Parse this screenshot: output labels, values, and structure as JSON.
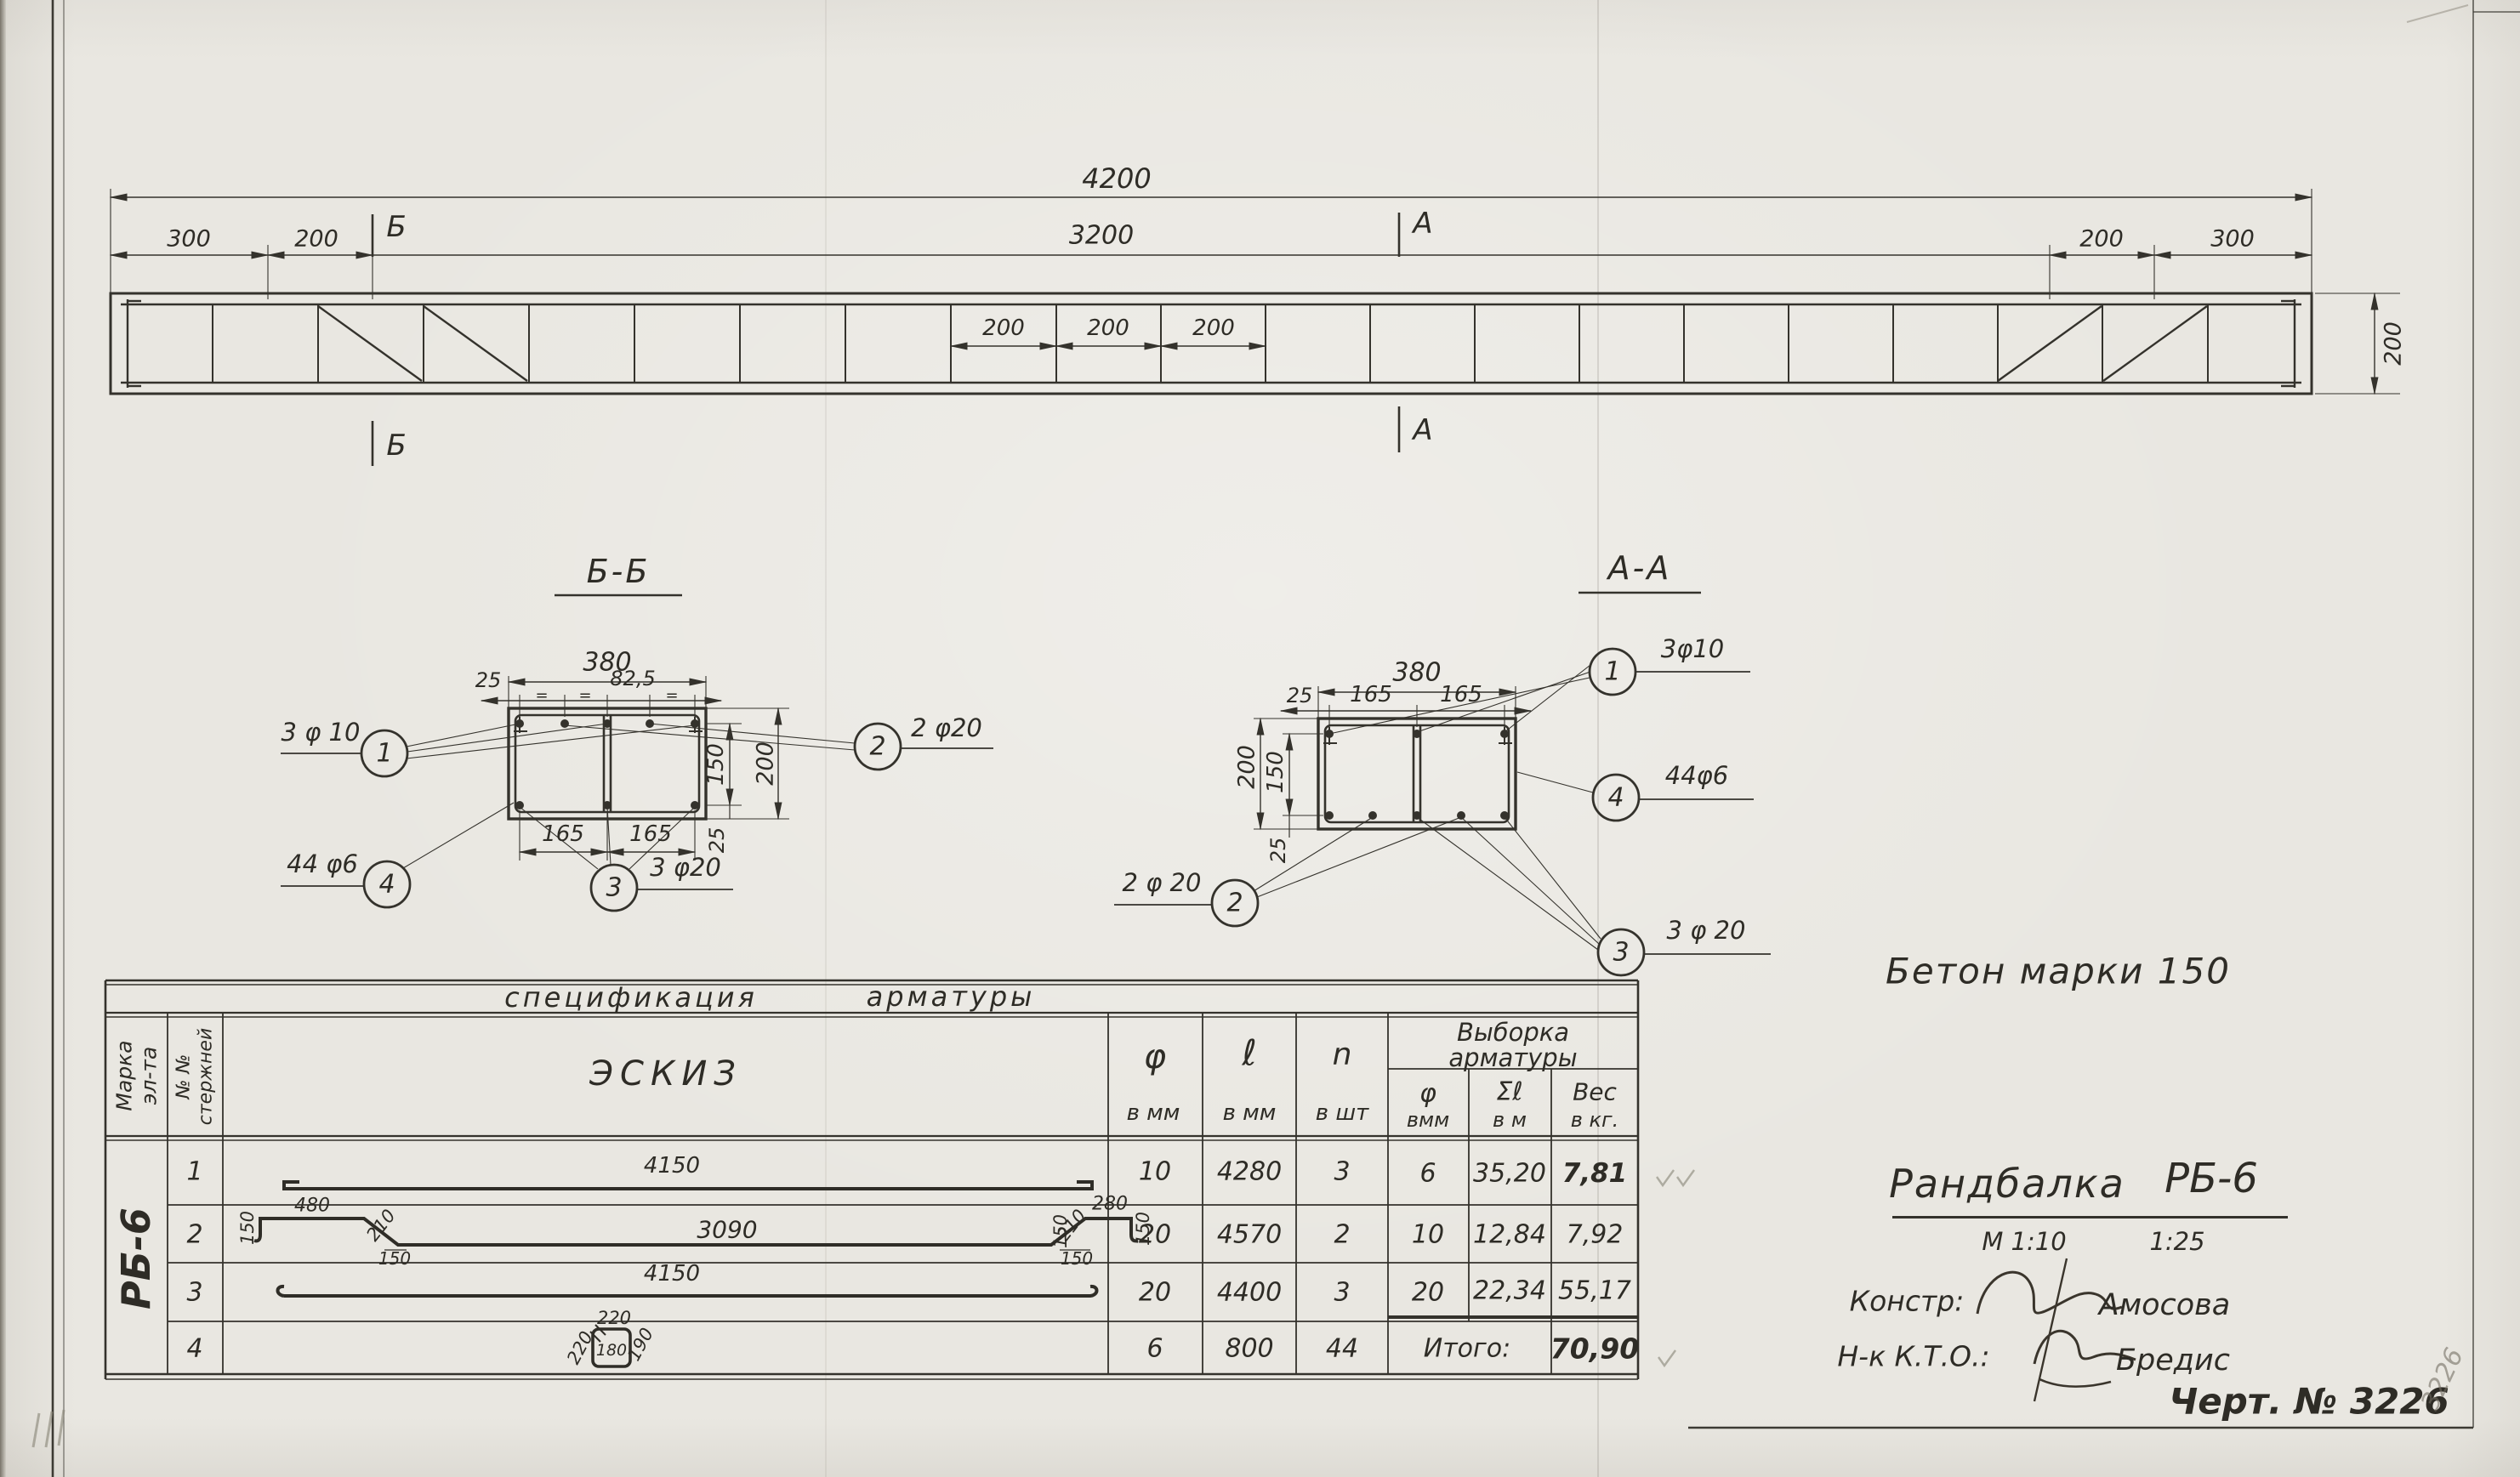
{
  "elevation": {
    "dim_total": "4200",
    "dim_left_300": "300",
    "dim_left_200": "200",
    "dim_mid_3200": "3200",
    "dim_right_200": "200",
    "dim_right_300": "300",
    "dim_int_1": "200",
    "dim_int_2": "200",
    "dim_int_3": "200",
    "dim_height": "200",
    "mark_b_top": "Б",
    "mark_b_bottom": "Б",
    "mark_a_top": "А",
    "mark_a_bottom": "А"
  },
  "section_bb": {
    "title": "Б-Б",
    "dim_width": "380",
    "dim_cover_left": "25",
    "dim_spacing": "82,5",
    "eq_mark": "=",
    "dim_150": "150",
    "dim_200": "200",
    "dim_25_bottom": "25",
    "dim_165_left": "165",
    "dim_165_right": "165",
    "callout_1_num": "1",
    "callout_1_label": "3 φ 10",
    "callout_2_num": "2",
    "callout_2_label": "2 φ20",
    "callout_3_num": "3",
    "callout_3_label": "3 φ20",
    "callout_4_num": "4",
    "callout_4_label": "44 φ6"
  },
  "section_aa": {
    "title": "А-А",
    "dim_width": "380",
    "dim_cover_left": "25",
    "dim_165_left": "165",
    "dim_165_right": "165",
    "dim_200": "200",
    "dim_150": "150",
    "dim_25_bottom": "25",
    "callout_1_num": "1",
    "callout_1_label": "3φ10",
    "callout_2_num": "2",
    "callout_2_label": "2 φ 20",
    "callout_3_num": "3",
    "callout_3_label": "3 φ 20",
    "callout_4_num": "4",
    "callout_4_label": "44φ6"
  },
  "table": {
    "title_word1": "спецификация",
    "title_word2": "арматуры",
    "h_marka_1": "Марка",
    "h_marka_2": "эл-та",
    "h_num_1": "№ №",
    "h_num_2": "стержней",
    "h_eskiz": "ЭСКИЗ",
    "h_dia": "φ",
    "h_dia_u": "в мм",
    "h_len": "ℓ",
    "h_len_u": "в мм",
    "h_qty": "n",
    "h_qty_u": "в шт",
    "h_vyborka_1": "Выборка",
    "h_vyborka_2": "арматуры",
    "h_vdia": "φ",
    "h_vdia_u": "вмм",
    "h_vlen": "Σℓ",
    "h_vlen_u": "в м",
    "h_vwt": "Вес",
    "h_vwt_u": "в кг.",
    "marka": "РБ-6",
    "r1": {
      "no": "1",
      "len_label": "4150",
      "dia": "10",
      "len": "4280",
      "qty": "3",
      "vdia": "6",
      "vlen": "35,20",
      "vwt": "7,81"
    },
    "r2": {
      "no": "2",
      "hook_l": "150",
      "top_l": "480",
      "diag_l": "210",
      "base_l": "150",
      "mid": "3090",
      "rise_r": "150",
      "diag_r": "210",
      "base_r": "150",
      "top_r": "280",
      "hook_r": "150",
      "dia": "20",
      "len": "4570",
      "qty": "2",
      "vdia": "10",
      "vlen": "12,84",
      "vwt": "7,92"
    },
    "r3": {
      "no": "3",
      "len_label": "4150",
      "dia": "20",
      "len": "4400",
      "qty": "3",
      "vdia": "20",
      "vlen": "22,34",
      "vwt": "55,17"
    },
    "r4": {
      "no": "4",
      "top": "220",
      "left": "220",
      "inner": "180",
      "right": "190",
      "dia": "6",
      "len": "800",
      "qty": "44",
      "total_label": "Итого:",
      "vwt": "70,90"
    }
  },
  "notes": {
    "concrete": "Бетон марки 150",
    "title": "Рандбалка",
    "title_mark": "РБ-6",
    "scale_main": "М 1:10",
    "scale_alt": "1:25",
    "sig1_label": "Констр:",
    "sig1_name": "Амосова",
    "sig2_label": "Н-к К.Т.О.:",
    "sig2_name": "Бредис",
    "drawing_no": "Черт. № 3226",
    "pencil_no": "3226"
  }
}
